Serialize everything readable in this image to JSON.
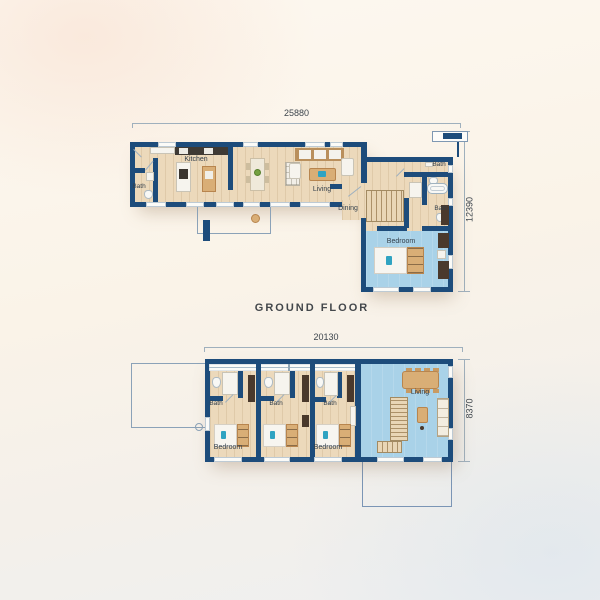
{
  "colors": {
    "wall": "#1d4c7b",
    "wood_floor": "#ecd9bb",
    "blue_floor": "#a9d2e8",
    "furniture_wood": "#d9ae76",
    "furniture_dark": "#4a392c",
    "accent_teal": "#2fa3c2",
    "plant_green": "#74a040",
    "dimension_line": "#9fb0bd",
    "label_text": "#333f4b",
    "background": "#f8f2e9"
  },
  "ground_floor": {
    "title": "GROUND FLOOR",
    "width_dim": "25880",
    "height_dim": "12390",
    "labels": {
      "bath_left": "Bath",
      "kitchen": "Kitchen",
      "living": "Living",
      "dining": "Dining",
      "bath_upper": "Bath",
      "bath_lower": "Bath",
      "bedroom": "Bedroom"
    }
  },
  "upper_floor": {
    "width_dim": "20130",
    "height_dim": "8370",
    "labels": {
      "bath_1": "Bath",
      "bath_2": "Bath",
      "bath_3": "Bath",
      "bedroom_1": "Bedroom",
      "bedroom_3": "Bedroom",
      "living": "Living"
    }
  }
}
